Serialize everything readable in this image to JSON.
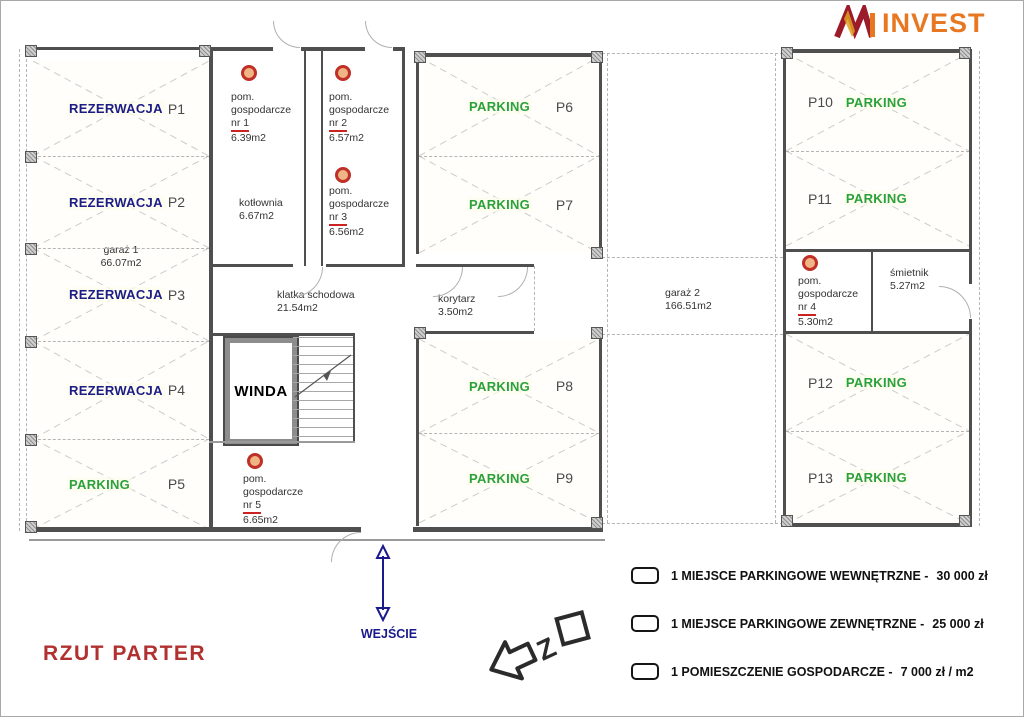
{
  "logo": {
    "name": "INVEST",
    "mark": "M"
  },
  "title": "RZUT PARTER",
  "entrance": {
    "label": "WEJŚCIE"
  },
  "compass": {
    "letter": "Z"
  },
  "stalls": {
    "p1": {
      "id": "P1",
      "status": "REZERWACJA"
    },
    "p2": {
      "id": "P2",
      "status": "REZERWACJA"
    },
    "p3": {
      "id": "P3",
      "status": "REZERWACJA"
    },
    "p4": {
      "id": "P4",
      "status": "REZERWACJA"
    },
    "p5": {
      "id": "P5",
      "status": "PARKING"
    },
    "p6": {
      "id": "P6",
      "status": "PARKING"
    },
    "p7": {
      "id": "P7",
      "status": "PARKING"
    },
    "p8": {
      "id": "P8",
      "status": "PARKING"
    },
    "p9": {
      "id": "P9",
      "status": "PARKING"
    },
    "p10": {
      "id": "P10",
      "status": "PARKING"
    },
    "p11": {
      "id": "P11",
      "status": "PARKING"
    },
    "p12": {
      "id": "P12",
      "status": "PARKING"
    },
    "p13": {
      "id": "P13",
      "status": "PARKING"
    }
  },
  "rooms": {
    "pg1": {
      "line1": "pom.",
      "line2": "gospodarcze",
      "nr": "nr 1",
      "area": "6.39m2"
    },
    "pg2": {
      "line1": "pom.",
      "line2": "gospodarcze",
      "nr": "nr 2",
      "area": "6.57m2"
    },
    "pg3": {
      "line1": "pom.",
      "line2": "gospodarcze",
      "nr": "nr 3",
      "area": "6.56m2"
    },
    "pg4": {
      "line1": "pom.",
      "line2": "gospodarcze",
      "nr": "nr 4",
      "area": "5.30m2"
    },
    "pg5": {
      "line1": "pom.",
      "line2": "gospodarcze",
      "nr": "nr 5",
      "area": "6.65m2"
    },
    "kotlownia": {
      "name": "kotłownia",
      "area": "6.67m2"
    },
    "klatka_schodowa": {
      "name": "klatka schodowa",
      "area": "21.54m2"
    },
    "korytarz": {
      "name": "korytarz",
      "area": "3.50m2"
    },
    "garaz1": {
      "name": "garaż 1",
      "area": "66.07m2"
    },
    "garaz2": {
      "name": "garaż 2",
      "area": "166.51m2"
    },
    "smietnik": {
      "name": "śmietnik",
      "area": "5.27m2"
    },
    "winda": {
      "name": "WINDA"
    }
  },
  "legend": {
    "items": [
      {
        "label": "1 MIEJSCE PARKINGOWE WEWNĘTRZNE -",
        "price": "30 000 zł"
      },
      {
        "label": "1 MIEJSCE PARKINGOWE ZEWNĘTRZNE -",
        "price": "25 000 zł"
      },
      {
        "label": "1 POMIESZCZENIE GOSPODARCZE -",
        "price": "7 000 zł / m2"
      }
    ]
  },
  "colors": {
    "reservation": "#1c1c86",
    "parking": "#2ba13b",
    "title_red": "#b13030",
    "logo_orange": "#e87722",
    "logo_dark_red": "#9b1b2b",
    "marker_ring": "#c03028",
    "marker_fill": "#efb584"
  }
}
